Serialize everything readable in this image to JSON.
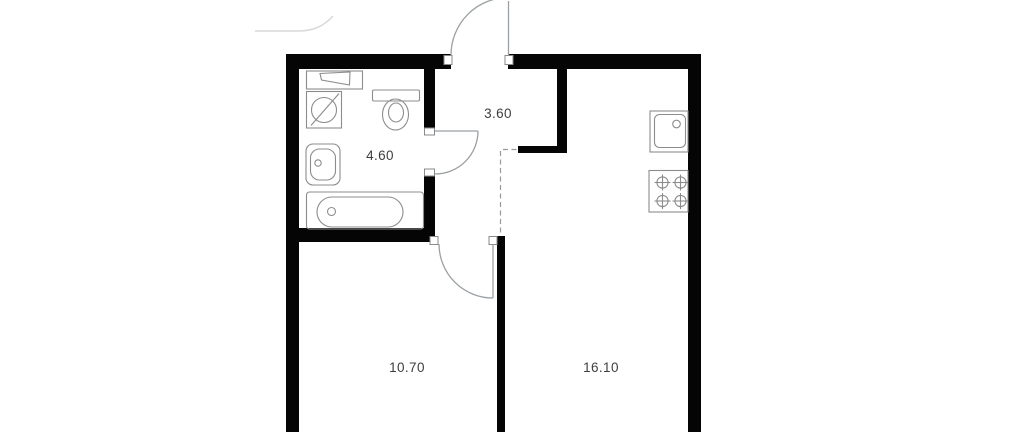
{
  "floor_plan": {
    "title": "one-room apartment floor plan",
    "rooms": [
      {
        "id": "bathroom",
        "area": "4.60"
      },
      {
        "id": "hallway",
        "area": "3.60"
      },
      {
        "id": "bedroom",
        "area": "10.70"
      },
      {
        "id": "kitchen-living",
        "area": "16.10"
      }
    ],
    "fixtures": [
      "shelf",
      "washing-machine",
      "toilet",
      "washbasin",
      "bathtub",
      "kitchen-sink",
      "stove"
    ],
    "doors": [
      "entrance-door",
      "bathroom-door",
      "bedroom-door"
    ],
    "colors": {
      "wall": "#050505",
      "fixture_line": "#8c8c8c",
      "door_line": "#9aa0a3",
      "dashed_line": "#9a9a9a",
      "jamb_line": "#8a8a8a",
      "faint_line": "#d9d9d9",
      "label": "#3e3e3e",
      "background": "#ffffff"
    }
  }
}
